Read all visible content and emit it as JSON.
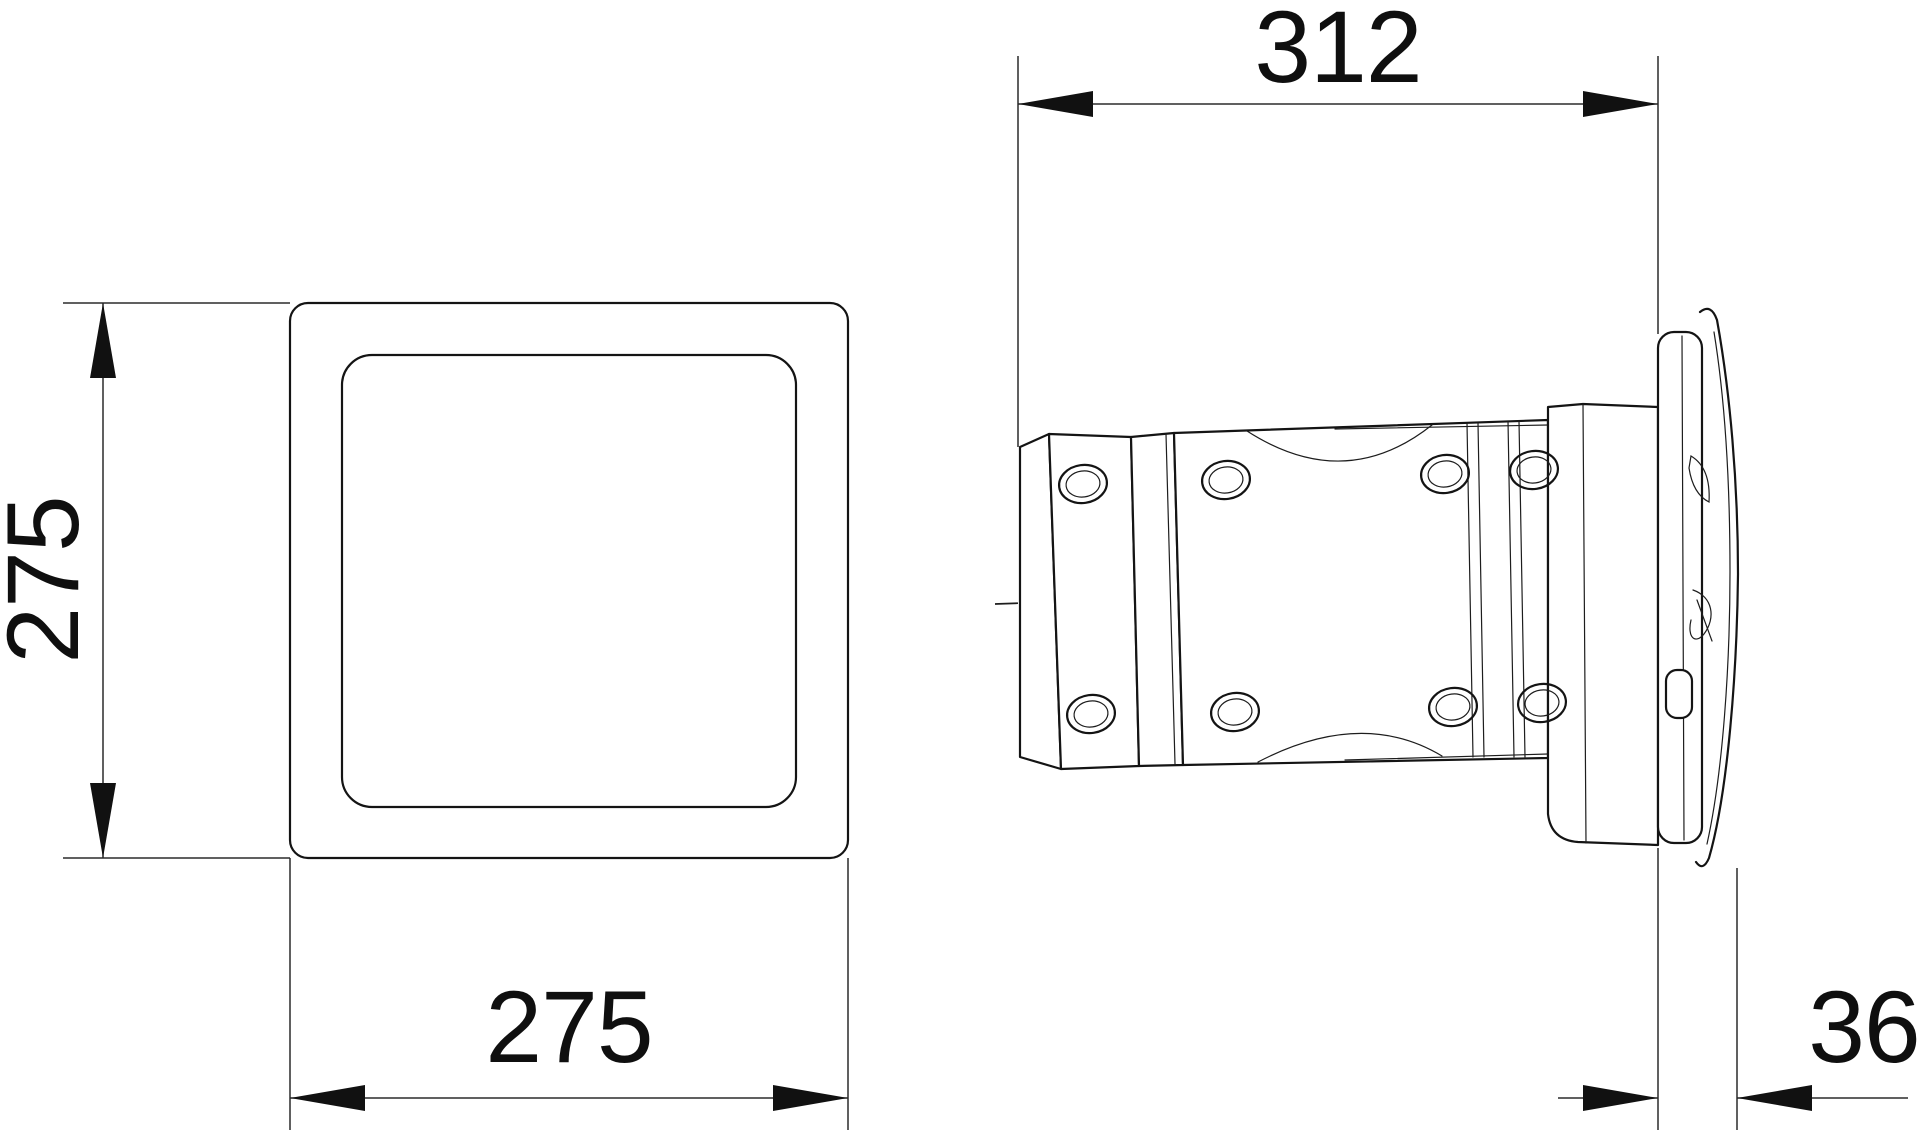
{
  "drawing": {
    "dimensions": {
      "front_height": {
        "value": "275"
      },
      "front_width": {
        "value": "275"
      },
      "side_length": {
        "value": "312"
      },
      "side_protrusion": {
        "value": "36"
      }
    }
  }
}
